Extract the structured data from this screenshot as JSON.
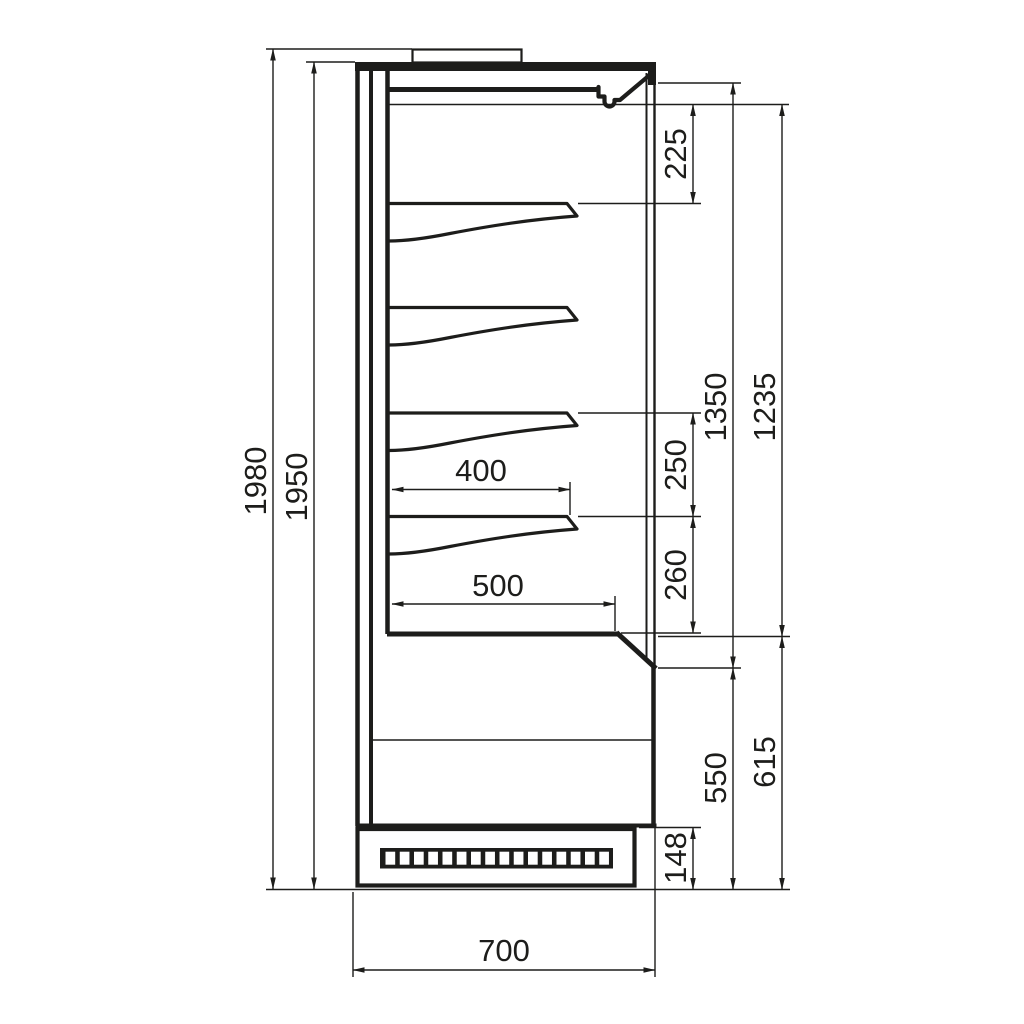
{
  "colors": {
    "line": "#1d1d1b",
    "background": "#ffffff"
  },
  "dimensions": {
    "overall_height": "1980",
    "body_height": "1950",
    "canopy_to_first_shelf": "225",
    "opening_height": "1350",
    "interior_height": "1235",
    "shelf_gap_upper": "250",
    "shelf_to_deck": "260",
    "shelf_depth": "400",
    "deck_depth": "500",
    "lower_front_height": "550",
    "base_section_height": "615",
    "plinth_height": "148",
    "overall_depth": "700"
  },
  "structure": {
    "shelf_count": 4,
    "grille_slot_count": 16
  }
}
